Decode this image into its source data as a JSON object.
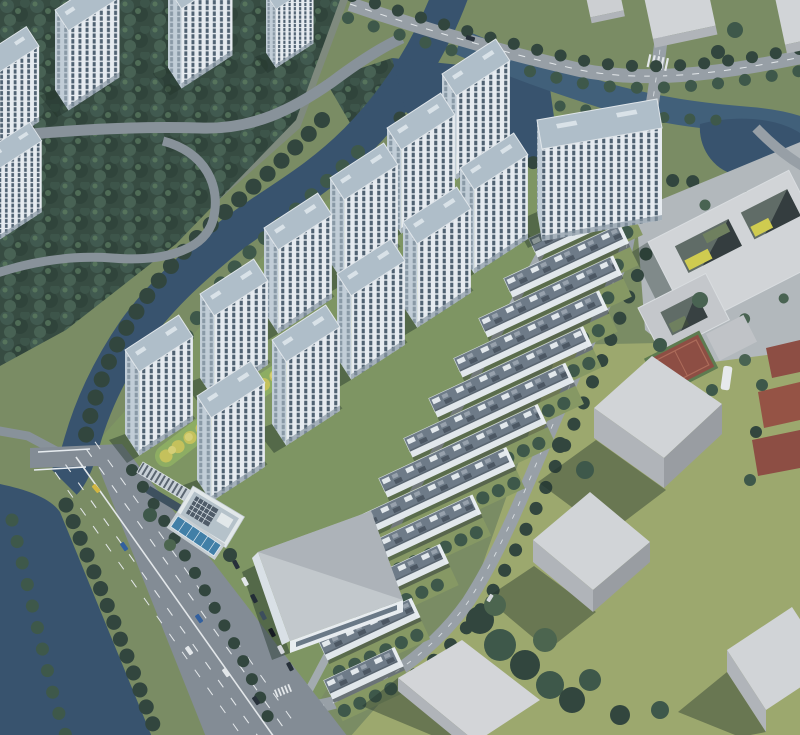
{
  "meta": {
    "type": "architectural-aerial-rendering",
    "alt": "Bird's-eye aerial rendering of a riverside residential development: white high-rise apartment towers and diagonal rows of low-rise townhouses set in landscaped gardens, bordered by a canal with tree-lined banks, a wide arterial road with traffic, a clubhouse with swimming pool, a large commercial building with parking, red sports courts, a courtyard school building and grey massing blocks of neighbouring plots.",
    "counts": {
      "apartment_towers": 12,
      "townhouse_rows": 13,
      "existing_towers": 5,
      "massing_blocks": 7
    }
  },
  "colors": {
    "base": "#7b8c5f",
    "existingGround": "#80897b",
    "siteLawn": "#7f955e",
    "brightLawn": "#8fae5e",
    "warmGrass": "#9fa96a",
    "forest": "#34483c",
    "water": "#3f5d77",
    "waterDeep": "#35506a",
    "plaza": "#b6babc",
    "roadMain": "#848c93",
    "roadTop": "#99a0a5",
    "roadSite": "#9aa1a6",
    "laneMark": "#e9ebec",
    "towerRoof": "#b3c0ca",
    "towerFace": "#ecf0f3",
    "towerWin": "#4e5f6e",
    "towerSide": "#c6d0d8",
    "towerSideWin": "#8b99a5",
    "towerTrim": "#e6eaed",
    "rowRoof": "#6e7a85",
    "rowSkylight": "#e8ecef",
    "rowPanel": "#4a545e",
    "rowPanelLight": "#99a2ab",
    "rowFacade": "#e7ebee",
    "rowGrass": "#87985f",
    "massingTop": "#d6d7d8",
    "massingSide": "#b4b6b9",
    "massingDark": "#9b9ea1",
    "shadow": "rgba(32,46,36,0.45)",
    "treeDark": "#2f4237",
    "treeMid": "#4a6349",
    "treeLight": "#5d7a55",
    "treeYellow": "#c9c357",
    "treeYellowLight": "#dbd272",
    "treePink": "#c489a4",
    "court": "#8f4a3e",
    "pool": "#3f7ea6",
    "poolLane": "#dfeaf2",
    "pergola": "#cdd3d8",
    "pergolaRib": "#5a646d",
    "solar": "#4d5965",
    "white": "#eef1f3",
    "carBlue": "#2f5d9e",
    "carYellow": "#d8b83a",
    "carDark": "#232b33",
    "carWhite": "#e8eaeb",
    "courtyard": "#5f6a62",
    "courtyardYellow": "#d4ce4a",
    "courtyardGreen": "#6f7f5a"
  }
}
